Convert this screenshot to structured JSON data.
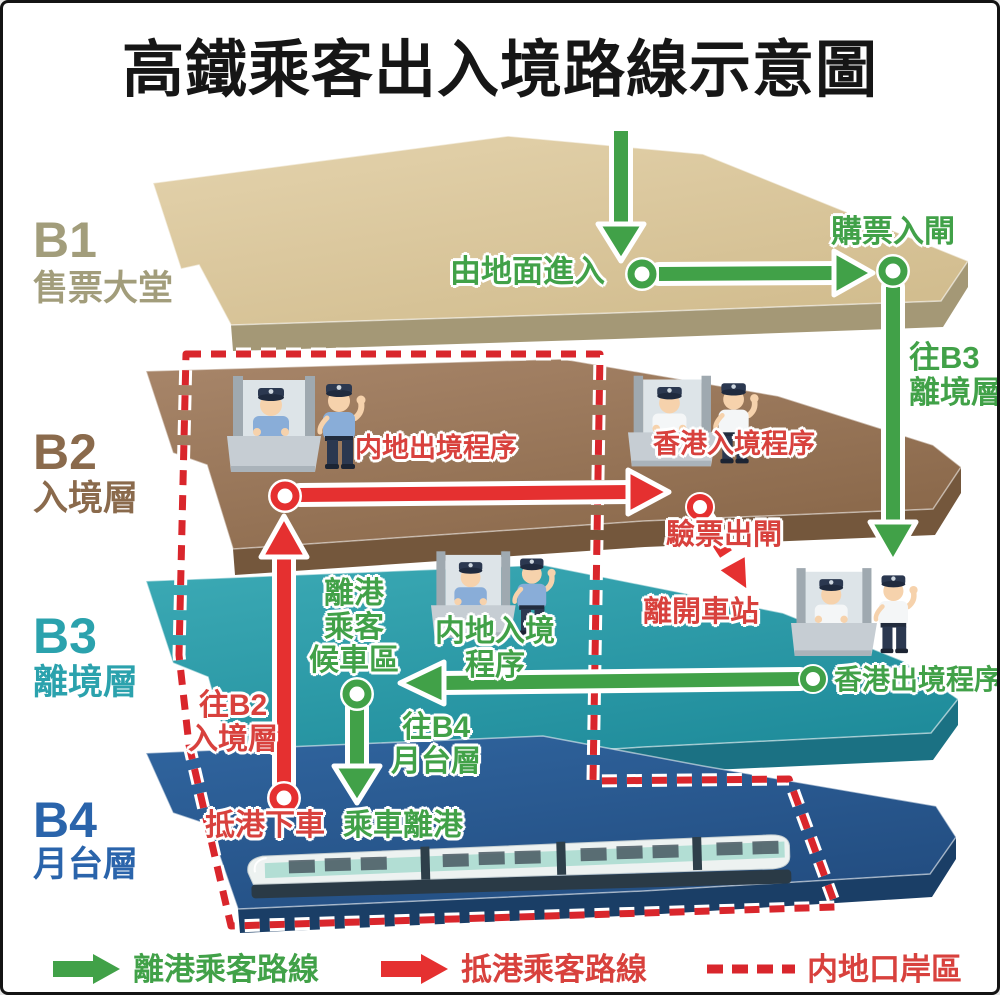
{
  "title": "高鐵乘客出入境路線示意圖",
  "floors": [
    {
      "code": "B1",
      "name": "售票大堂"
    },
    {
      "code": "B2",
      "name": "入境層"
    },
    {
      "code": "B3",
      "name": "離境層"
    },
    {
      "code": "B4",
      "name": "月台層"
    }
  ],
  "routes": {
    "enter_from_ground": "由地面進入",
    "buy_ticket_enter_gate": "購票入閘",
    "to_b3": {
      "line1": "往B3",
      "line2": "離境層"
    },
    "mainland_departure": "内地出境程序",
    "hk_arrival": "香港入境程序",
    "ticket_check_exit_gate": "驗票出閘",
    "leave_station": "離開車站",
    "departure_waiting": {
      "line1": "離港",
      "line2": "乘客",
      "line3": "候車區"
    },
    "mainland_arrival": {
      "line1": "内地入境",
      "line2": "程序"
    },
    "hk_departure": "香港出境程序",
    "to_b4": {
      "line1": "往B4",
      "line2": "月台層"
    },
    "to_b2": {
      "line1": "往B2",
      "line2": "入境層"
    },
    "arrival_alight": "抵港下車",
    "board_train_depart": "乘車離港"
  },
  "legend": [
    {
      "icon": "green-arrow-icon",
      "label": "離港乘客路線"
    },
    {
      "icon": "red-arrow-icon",
      "label": "抵港乘客路線"
    },
    {
      "icon": "red-dashed-line-icon",
      "label": "内地口岸區"
    }
  ],
  "colors": {
    "departure_route_green": "#41a148",
    "arrival_route_red": "#e53030",
    "mainland_port_area_red": "#d9262c",
    "b1_slab": "#dcc9a0",
    "b2_slab": "#9c7a5c",
    "b3_slab": "#2a9cab",
    "b4_slab": "#2a5b94",
    "b1_label": "#a29d7b",
    "b2_label": "#8a6a4c",
    "b3_label": "#2ba2ad",
    "b4_label": "#2a64ab"
  }
}
